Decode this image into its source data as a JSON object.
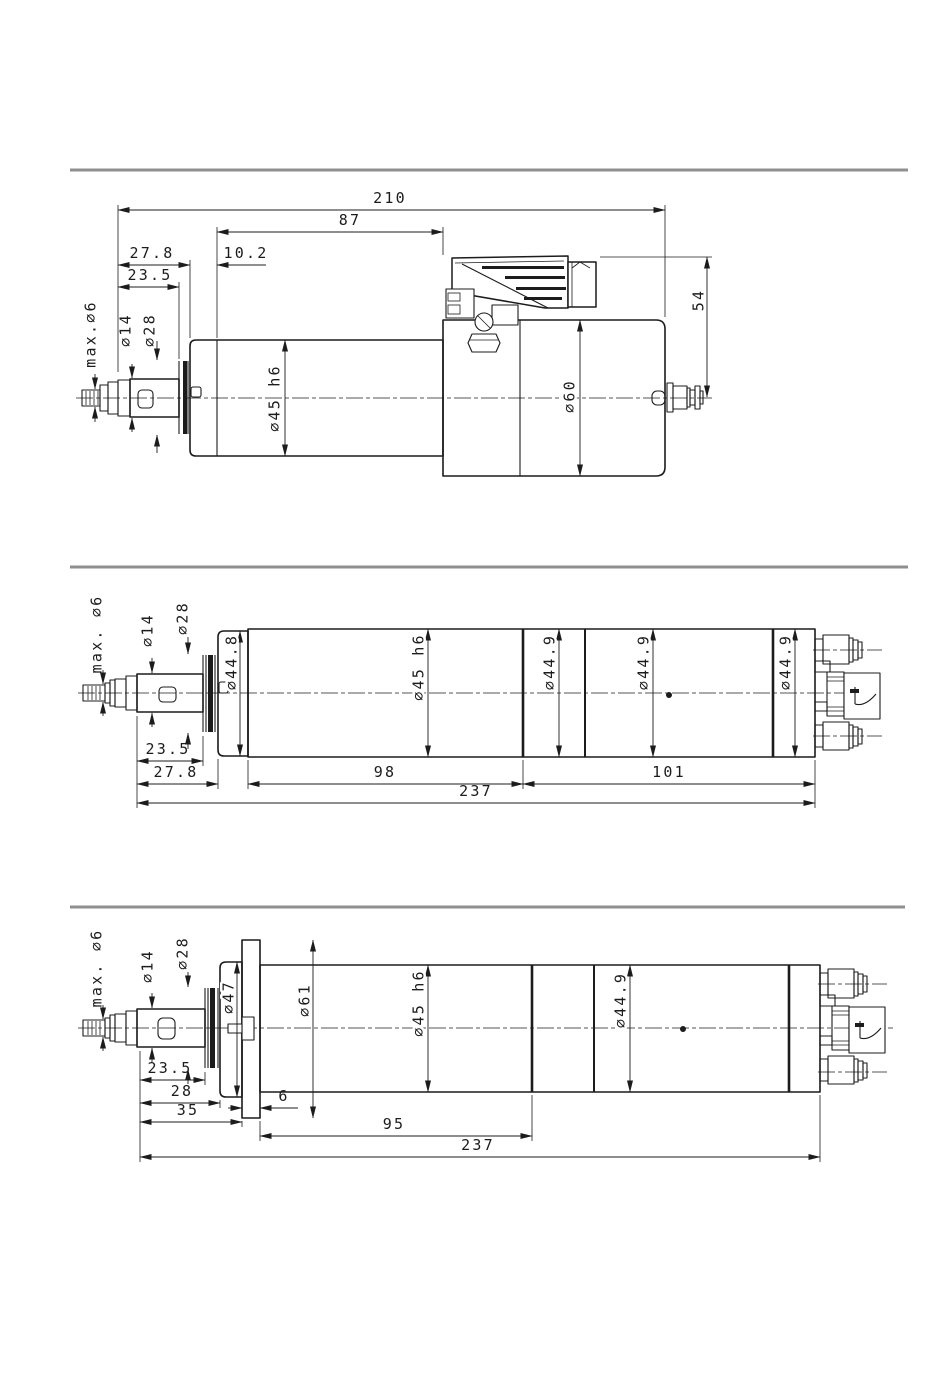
{
  "drawing": {
    "colors": {
      "line": "#1c1c1c",
      "separator": "#8f8f8f",
      "background": "#ffffff"
    },
    "views": {
      "top": {
        "dims": {
          "overall_length": "210",
          "body_length": "87",
          "nose_length": "27.8",
          "nose_step": "10.2",
          "chuck_length": "23.5",
          "shaft_dia": "max.∅6",
          "chuck_dia": "∅14",
          "collar_dia": "∅28",
          "body_dia": "∅45 h6",
          "motor_dia": "∅60",
          "connector_height": "54"
        }
      },
      "middle": {
        "dims": {
          "shaft_dia": "max. ∅6",
          "chuck_dia": "∅14",
          "collar_dia": "∅28",
          "cap_dia": "∅44.8",
          "body_dia": "∅45 h6",
          "rear_dia_1": "∅44.9",
          "rear_dia_2": "∅44.9",
          "rear_dia_3": "∅44.9",
          "chuck_length": "23.5",
          "nose_length": "27.8",
          "front_section": "98",
          "rear_section": "101",
          "total_length": "237"
        }
      },
      "bottom": {
        "dims": {
          "shaft_dia": "max. ∅6",
          "chuck_dia": "∅14",
          "collar_dia": "∅28",
          "cap_dia": "∅47",
          "flange_dia": "∅61",
          "body_dia": "∅45 h6",
          "rear_dia": "∅44.9",
          "chuck_length": "23.5",
          "cap_offset": "28",
          "flange_offset": "35",
          "flange_thickness": "6",
          "body_section": "95",
          "total_length": "237"
        }
      }
    }
  }
}
